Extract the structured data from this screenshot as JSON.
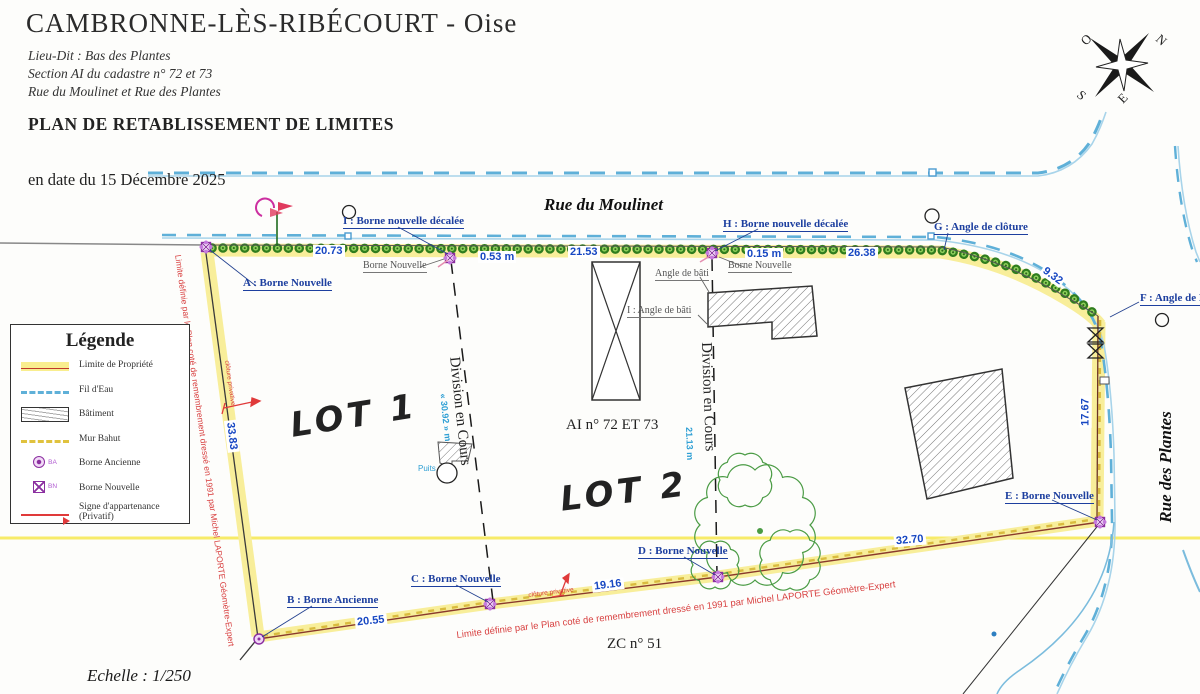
{
  "header": {
    "title": "CAMBRONNE-LÈS-RIBÉCOURT - Oise",
    "subtitle1": "Lieu-Dit : Bas  des  Plantes",
    "subtitle2": "Section AI du cadastre n° 72 et 73",
    "subtitle3": "Rue du Moulinet et Rue des Plantes",
    "plan_title": "PLAN DE RETABLISSEMENT DE LIMITES",
    "date_line": "en date du 15 Décembre 2025",
    "scale": "Echelle : 1/250"
  },
  "compass": {
    "n": "N",
    "s": "S",
    "e": "E",
    "o": "O"
  },
  "legend": {
    "title": "Légende",
    "items": [
      {
        "label": "Limite de Propriété"
      },
      {
        "label": "Fil d'Eau"
      },
      {
        "label": "Bâtiment"
      },
      {
        "label": "Mur Bahut"
      },
      {
        "label": "Borne Ancienne",
        "abbr": "BA"
      },
      {
        "label": "Borne Nouvelle",
        "abbr": "BN"
      },
      {
        "label": "Signe d'appartenance (Privatif)"
      }
    ]
  },
  "map": {
    "streets": {
      "north": "Rue du Moulinet",
      "east": "Rue des Plantes"
    },
    "lots": {
      "lot1": "LOT 1",
      "lot2": "LOT 2"
    },
    "parcel_ref": "AI n° 72 ET 73",
    "south_parcel_ref": "ZC n° 51",
    "points": {
      "A": "A : Borne Nouvelle",
      "B": "B : Borne Ancienne",
      "C": "C : Borne Nouvelle",
      "D": "D : Borne Nouvelle",
      "E": "E : Borne Nouvelle",
      "F": "F : Angle de Pile",
      "G": "G : Angle de clôture",
      "H": "H : Borne nouvelle décalée",
      "I": "I : Borne nouvelle décalée"
    },
    "sub_labels": {
      "borne_nouvelle": "Borne Nouvelle",
      "angle_bati": "Angle de bâti",
      "angle_bati_i": "I : Angle de bâti",
      "puits": "Puits"
    },
    "measurements": {
      "a_i": "20.73",
      "i_offset": "0.53 m",
      "i_h": "21.53",
      "h_offset": "0.15 m",
      "h_g": "26.38",
      "g_f": "9.32",
      "f_e": "17.67",
      "a_b": "33.83",
      "b_c": "20.55",
      "c_d": "19.16",
      "d_e": "32.70",
      "division1": "« 30.92 » m",
      "division2": "21.13 m"
    },
    "division_label": "Division en Cours",
    "annotations": {
      "limit_1991": "Limite définie par le Plan coté  de remembrement  dressé en 1991 par Michel LAPORTE  Géomètre-Expert",
      "cloture_privative": "clôture privative"
    }
  }
}
